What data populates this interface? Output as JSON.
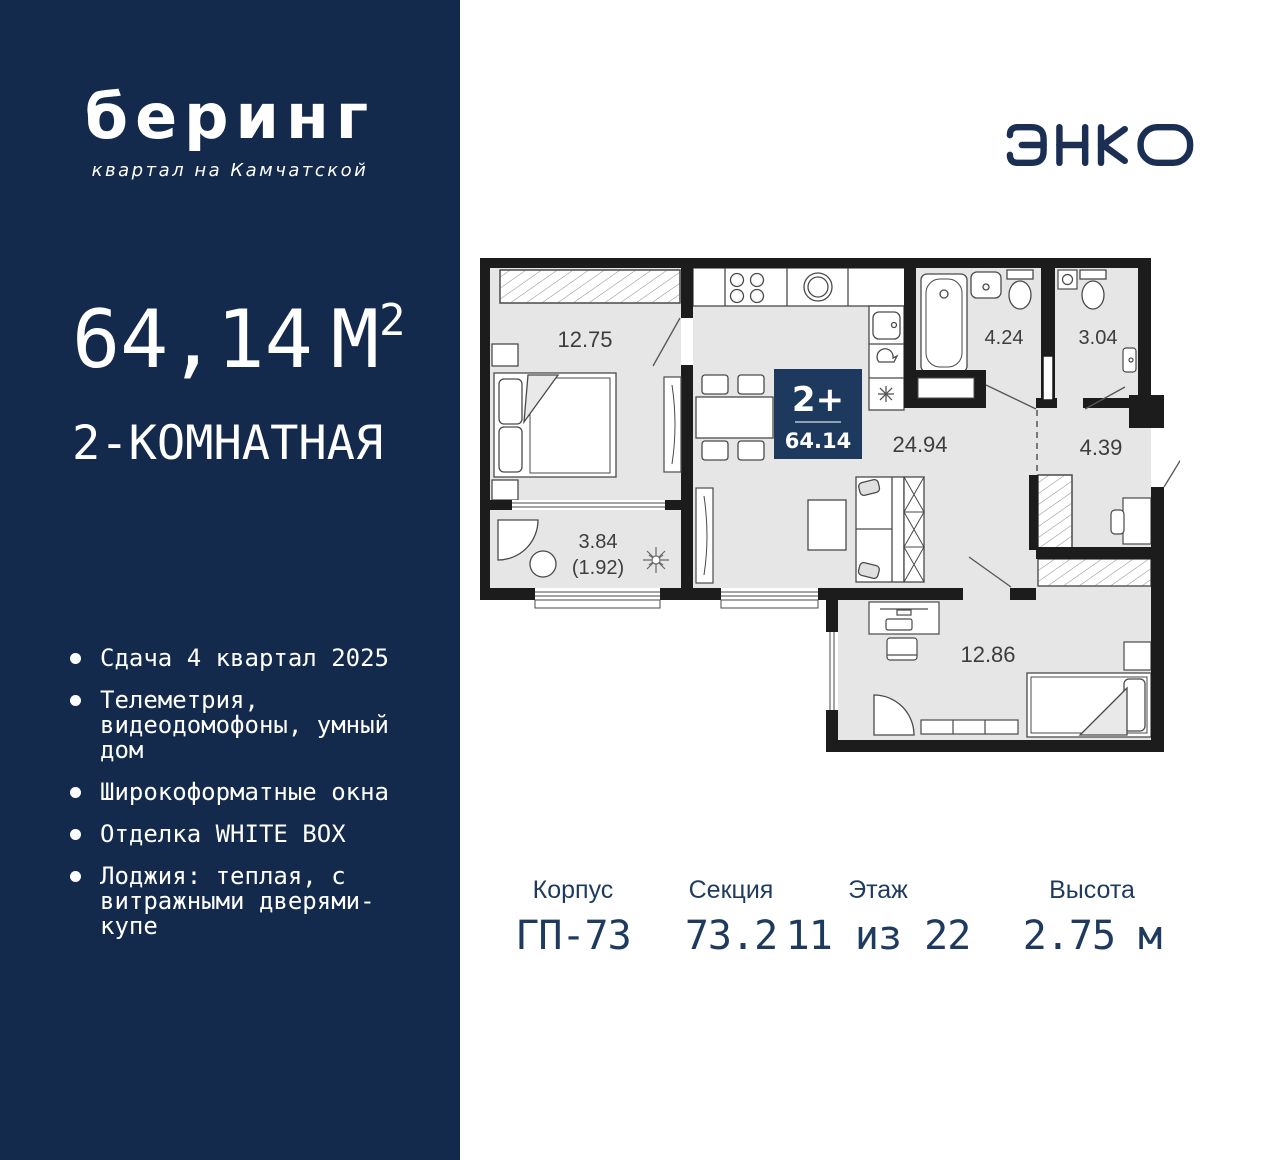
{
  "brand": {
    "logo_title": "беринг",
    "logo_subtitle": "квартал на Камчатской",
    "developer_logo": "ЭНКО"
  },
  "apartment": {
    "area_value": "64,14",
    "area_unit": "М",
    "area_sup": "2",
    "type_label": "2-КОМНАТНАЯ"
  },
  "features": [
    "Сдача 4 квартал 2025",
    "Телеметрия, видеодомофоны, умный дом",
    "Широкоформатные окна",
    "Отделка WHITE BOX",
    "Лоджия: теплая, с витражными дверями-купе"
  ],
  "plan": {
    "badge": {
      "rooms": "2+",
      "area": "64.14"
    },
    "rooms": {
      "bedroom1": "12.75",
      "loggia": "3.84",
      "loggia_half": "(1.92)",
      "living": "24.94",
      "bathroom": "4.24",
      "wc": "3.04",
      "hall": "4.39",
      "bedroom2": "12.86"
    }
  },
  "info": [
    {
      "label": "Корпус",
      "value": "ГП-73"
    },
    {
      "label": "Секция",
      "value": "73.2"
    },
    {
      "label": "Этаж",
      "value": "11 из 22"
    },
    {
      "label": "Высота",
      "value": "2.75 м"
    }
  ],
  "colors": {
    "sidebar": "#132a4c",
    "accent": "#1d3a5e",
    "navy_text": "#1e3a5f",
    "wall": "#1c1c1c",
    "room_fill": "#e6e6e6"
  }
}
